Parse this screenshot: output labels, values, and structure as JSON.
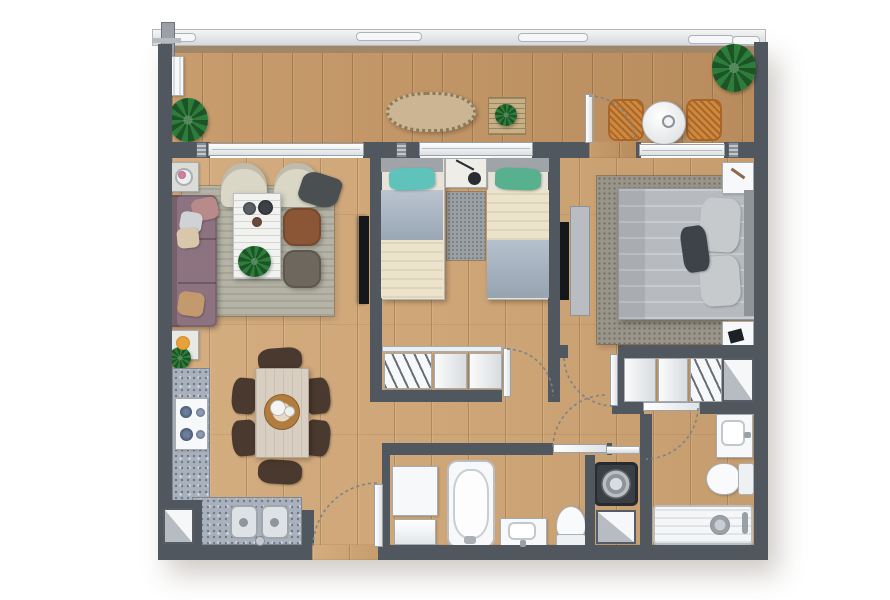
{
  "document": {
    "type": "apartment-floor-plan",
    "view": "top-down furnished rendering",
    "visible_text": [],
    "summary": "Two-bedroom, two-bathroom apartment with open living/dining/kitchen, full-width terrace at top, hallway with bathroom, laundry niche and en-suite bathroom"
  },
  "palette": {
    "wall": "#51575e",
    "wood_interior": "#cfa87b",
    "wood_terrace": "#c2966a",
    "window_frame": "#eef0f2",
    "railing": "#e9ebec",
    "rug_living": "#b4b3a5",
    "rug_master": "#99958a",
    "rug_small": "#9aa0a3",
    "sofa": "#8d7380",
    "armchair": "#dad7c7",
    "pouf_brown": "#8a5636",
    "pouf_gray": "#6e675d",
    "pillow_teal": "#5fc3bc",
    "pillow_green": "#57b08e",
    "duvet_cream": "#ece3cb",
    "duvet_blue": "#a3b1c0",
    "bed_master": "#b7bbbf",
    "pillow_dark": "#3d4349",
    "counter_granite": "#a9b1bc",
    "dining_chair": "#4a392e",
    "dining_table": "#d8cfc2",
    "terrace_chair": "#d0883f",
    "fixture_white": "#f7f8f9",
    "tv_black": "#15181b",
    "plant_green": "#2d7c39",
    "accent_rose": "#b98a8a"
  },
  "rooms": [
    {
      "id": "terrace",
      "name": "terrace",
      "furniture": [
        "ac-unit",
        "potted-plant",
        "fringed-bench",
        "slatted-plant-table",
        "rattan-chair",
        "round-side-table",
        "rattan-chair",
        "corner-plant",
        "terrace-swing-door"
      ]
    },
    {
      "id": "living-room",
      "name": "living room",
      "furniture": [
        "side-table-with-flowers",
        "armchair",
        "armchair-with-throw",
        "area-rug",
        "sofa-with-pillows",
        "coffee-table-with-plant",
        "leather-pouf",
        "fabric-pouf",
        "side-table-with-bowl",
        "small-plant",
        "wall-tv"
      ]
    },
    {
      "id": "dining-area",
      "name": "dining area",
      "furniture": [
        "dining-table",
        "centerpiece-tray",
        "dining-chair-x6"
      ]
    },
    {
      "id": "kitchen",
      "name": "kitchen",
      "furniture": [
        "l-shaped-granite-counter",
        "gas-hob-4-burner",
        "double-sink",
        "duct-shaft"
      ]
    },
    {
      "id": "bedroom-2",
      "name": "second bedroom",
      "furniture": [
        "single-bed-teal-pillow",
        "single-bed-green-pillow",
        "shared-nightstand-with-guitar",
        "runner-rug",
        "sliding-closet-with-hangers",
        "hinged-door"
      ]
    },
    {
      "id": "master-bedroom",
      "name": "master bedroom",
      "furniture": [
        "double-bed",
        "patterned-rug",
        "nightstand-x2",
        "tv-cabinet",
        "wall-tv",
        "hinged-door"
      ]
    },
    {
      "id": "master-closet",
      "name": "master closet",
      "furniture": [
        "sliding-panels",
        "hanger-rod",
        "duct-shaft"
      ]
    },
    {
      "id": "hallway",
      "name": "hallway",
      "furniture": [
        "door-swing-arcs"
      ]
    },
    {
      "id": "bathroom-1",
      "name": "family bathroom",
      "furniture": [
        "storage-cabinet",
        "bathtub",
        "washbasin",
        "toilet",
        "hinged-door"
      ]
    },
    {
      "id": "laundry-niche",
      "name": "laundry niche",
      "furniture": [
        "washing-machine",
        "shelf",
        "duct-shaft"
      ]
    },
    {
      "id": "master-bathroom",
      "name": "en-suite bathroom",
      "furniture": [
        "washbasin",
        "toilet",
        "walk-in-shower",
        "hinged-door"
      ]
    },
    {
      "id": "entry",
      "name": "entrance",
      "furniture": [
        "entry-door-with-swing-arc"
      ]
    }
  ],
  "symbols": {
    "door_swing": "dashed quarter-circle arc with white door leaf",
    "shaft": "white square with gray diagonal triangle (duct)",
    "hatched_pier": "speckled structural wall pier",
    "railing": "light balustrade band with rounded glass panels above terrace"
  },
  "counts": {
    "bedrooms": 2,
    "bathrooms": 2,
    "single_beds": 2,
    "double_beds": 1,
    "door_arcs": 6,
    "shafts": 3,
    "plants": 5,
    "closets": 2
  }
}
